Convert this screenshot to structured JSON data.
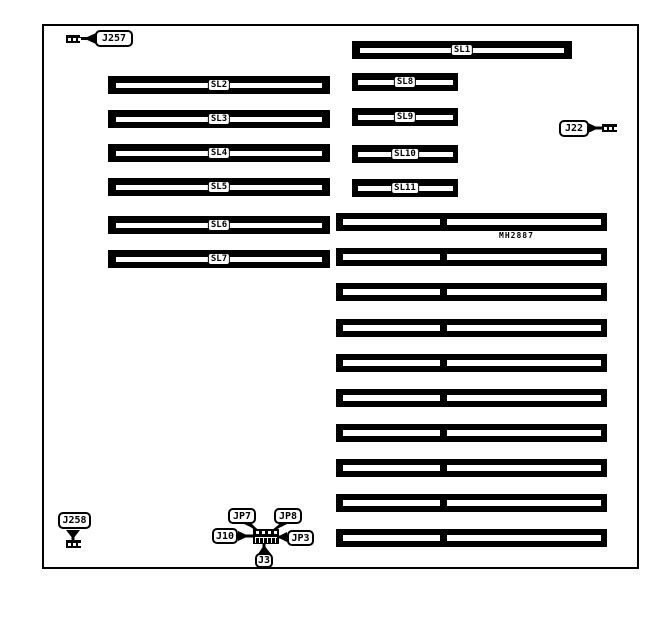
{
  "board": {
    "part_number": "MH2887"
  },
  "slots": {
    "left": [
      "SL2",
      "SL3",
      "SL4",
      "SL5",
      "SL6",
      "SL7"
    ],
    "right": [
      "SL1",
      "SL8",
      "SL9",
      "SL10",
      "SL11"
    ]
  },
  "connectors": {
    "j257": "J257",
    "j22": "J22",
    "j258": "J258",
    "jp7": "JP7",
    "jp8": "JP8",
    "j10": "J10",
    "jp3": "JP3",
    "j3": "J3"
  },
  "memory_banks": {
    "count": 10
  },
  "colors": {
    "ink": "#000000",
    "background": "#ffffff"
  }
}
